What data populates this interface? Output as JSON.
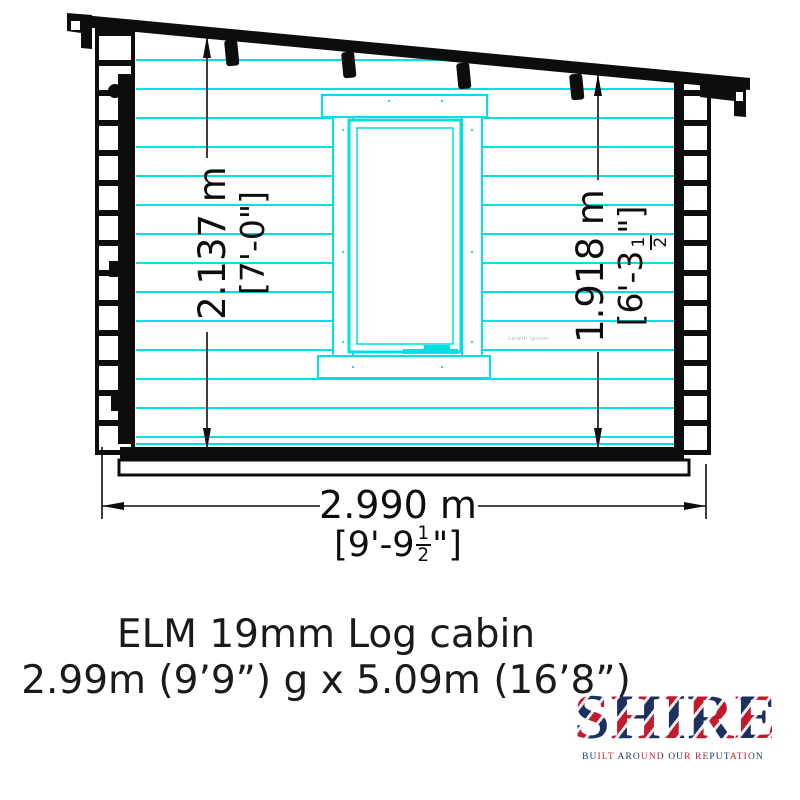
{
  "colors": {
    "accent": "#00dfe2",
    "ink": "#0d0d0d",
    "text": "#1a1a1a",
    "navy": "#1d3160",
    "red": "#c21a2c",
    "faint": "#93bcc0"
  },
  "drawing": {
    "dim_left": {
      "meters": "2.137 m",
      "feet": "[7'-0\"]"
    },
    "dim_right": {
      "meters": "1.918 m",
      "feet_prefix": "[6'-3",
      "frac_num": "1",
      "frac_den": "2",
      "feet_suffix": "\"]"
    },
    "dim_bottom": {
      "meters": "2.990 m",
      "feet_prefix": "[9'-9",
      "frac_num": "1",
      "frac_den": "2",
      "feet_suffix": "\"]"
    },
    "window_watermark": "Lorem Ipsum"
  },
  "title": {
    "line1": "ELM 19mm Log cabin",
    "line2": "2.99m (9’9”) g  x 5.09m (16’8”)"
  },
  "logo": {
    "brand": "SHIRE",
    "tagline": "BUILT AROUND OUR REPUTATION"
  }
}
